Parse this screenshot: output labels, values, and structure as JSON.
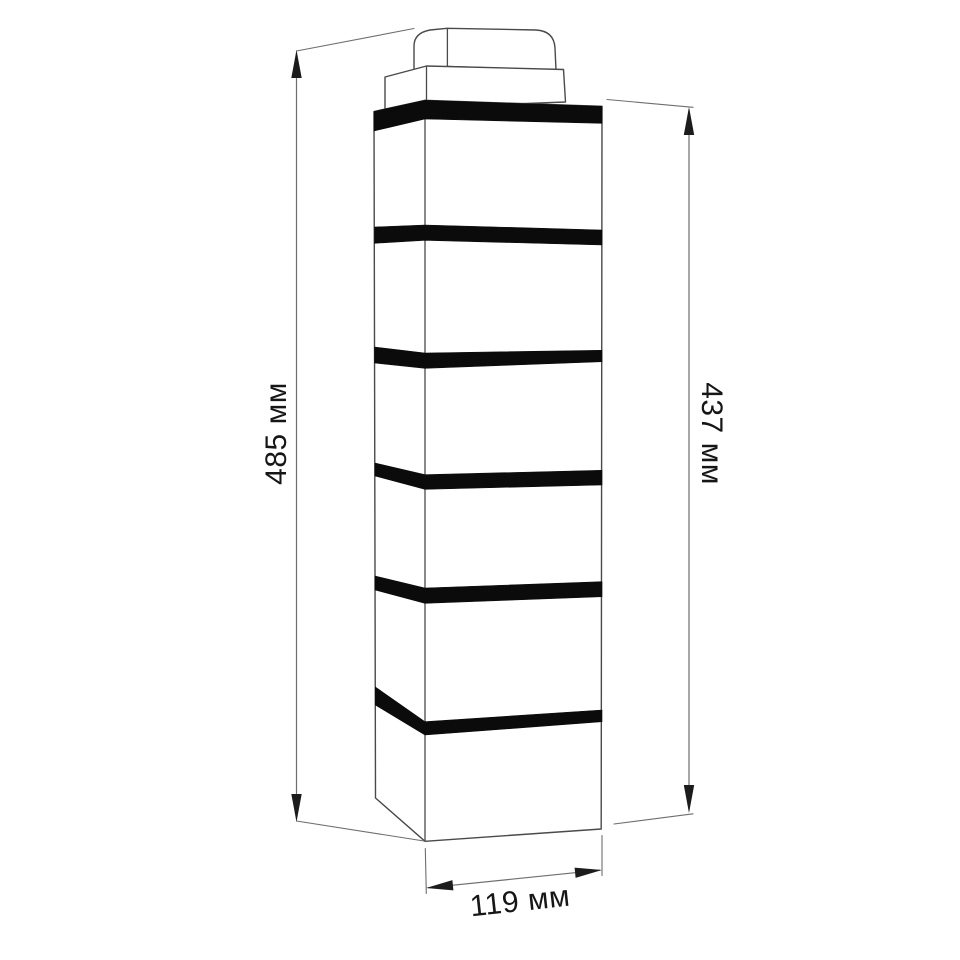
{
  "diagram": {
    "type": "technical-dimension-drawing",
    "subject": "brick-corner-siding-panel",
    "bands_count": 6,
    "dimensions": {
      "overall_height": {
        "label": "485 мм",
        "value": 485,
        "unit": "мм",
        "position": "left"
      },
      "panel_height": {
        "label": "437 мм",
        "value": 437,
        "unit": "мм",
        "position": "right"
      },
      "width": {
        "label": "119 мм",
        "value": 119,
        "unit": "мм",
        "position": "bottom"
      }
    },
    "colors": {
      "background": "#ffffff",
      "outline": "#4a4a4a",
      "dimension_line": "#6e6e6e",
      "arrow": "#1c1c1c",
      "band": "#0b0b0b",
      "face": "#ffffff",
      "label": "#161616"
    }
  }
}
